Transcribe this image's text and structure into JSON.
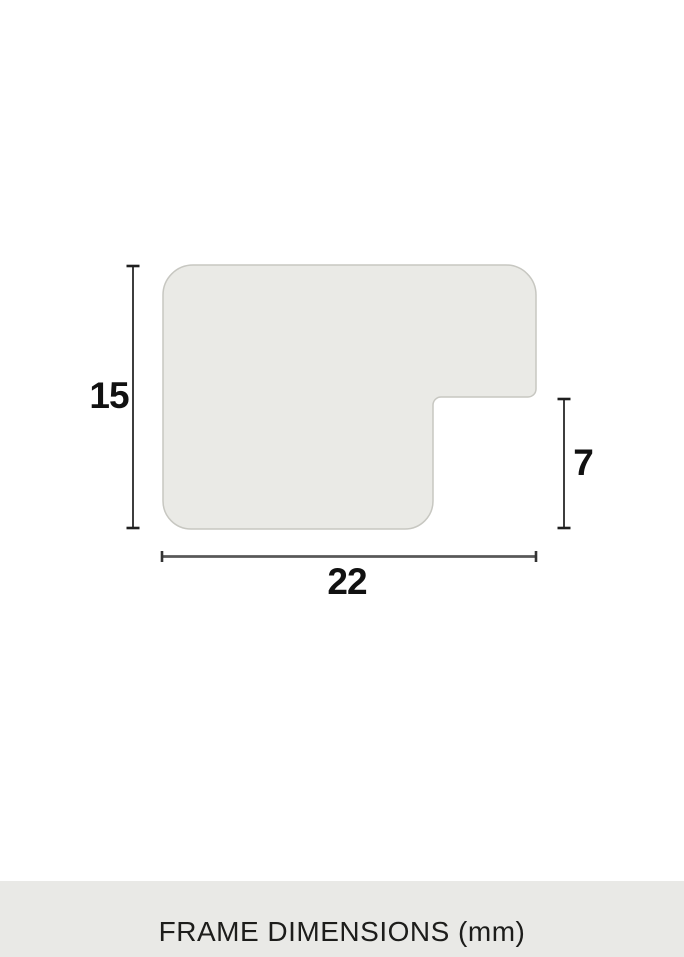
{
  "diagram": {
    "title": "frame-moulding-profile-cross-section",
    "labels": {
      "height": "15",
      "rabbet_depth": "7",
      "width": "22"
    },
    "unit": "mm",
    "colors": {
      "profile_fill": "#EAEAE6",
      "profile_border": "#C7C7C1",
      "dimension_line": "#3D3D3D",
      "dimension_line_horizontal": "#585858",
      "dimension_cap": "#1F1F1F",
      "label_text": "#111111"
    }
  },
  "footer": {
    "caption": "FRAME DIMENSIONS (mm)",
    "background": "#E9E9E6",
    "text_color": "#1D1D1B"
  }
}
